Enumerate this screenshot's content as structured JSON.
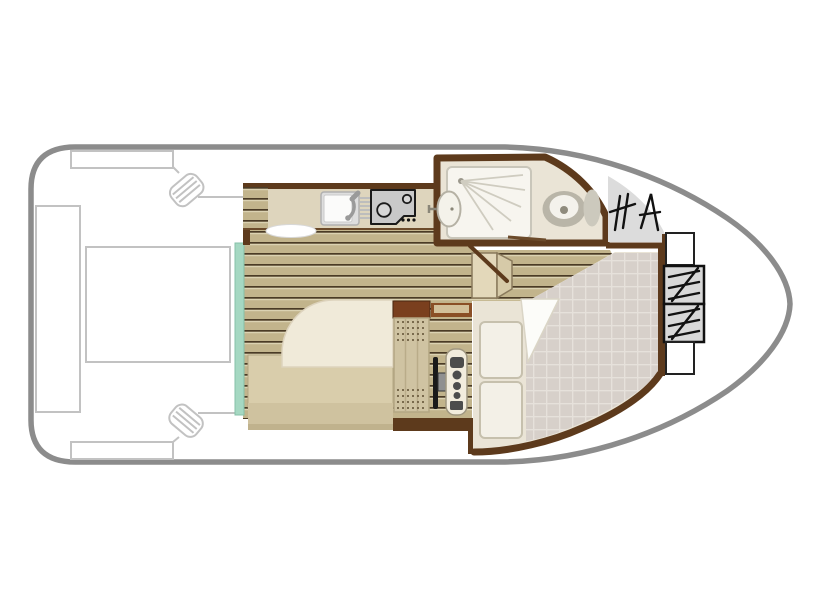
{
  "diagram": {
    "type": "boat-deck-floor-plan",
    "orientation": "bow-right-stern-left",
    "areas": [
      {
        "id": "aft-deck",
        "features": [
          "transom-bench",
          "deck-table",
          "side-walkway-port",
          "side-walkway-starboard",
          "cleat-port",
          "cleat-starboard"
        ]
      },
      {
        "id": "galley",
        "features": [
          "kitchen-counter",
          "side-cabinet",
          "sink",
          "faucet",
          "drainer",
          "stove-two-burner",
          "fold-table"
        ]
      },
      {
        "id": "saloon",
        "features": [
          "double-bed",
          "duvet",
          "entry-step-teal"
        ]
      },
      {
        "id": "helm",
        "features": [
          "helm-seat",
          "steering-wheel",
          "dashboard",
          "storage-cabinet",
          "shelf"
        ]
      },
      {
        "id": "bathroom",
        "features": [
          "shower",
          "washbasin",
          "toilet",
          "sliding-door"
        ]
      },
      {
        "id": "bow-cabin",
        "features": [
          "v-berth-quilted-mattress",
          "pillow-upper",
          "pillow-lower",
          "folded-sheet",
          "companionway-steps"
        ]
      },
      {
        "id": "bow-deck",
        "features": [
          "deck-steps-hatching",
          "step-box-upper",
          "step-box-lower",
          "locker-upper",
          "locker-lower"
        ]
      }
    ]
  },
  "colors": {
    "background": "#ffffff",
    "hull_outline": "#8c8c8c",
    "deck_outline": "#c2c2c2",
    "wall_brown": "#5d3a1c",
    "cabinet_brown": "#7a3f1e",
    "shelf_brown": "#8a4f26",
    "shelf_inlay": "#d2c09a",
    "plank_base": "#c2b48c",
    "plank_dark": "#4a3b26",
    "plank_light": "#dbd2b2",
    "counter": "#ded5bd",
    "counter_edge": "#6b4a2a",
    "teal_accent": "#a5d8c2",
    "teal_border": "#86c0a8",
    "bed_base": "#d9cdab",
    "bed_foot": "#cfc29f",
    "bed_blanket": "#f0ead9",
    "bed_blanket_edge": "#ddd3bd",
    "seat": "#cfc3a2",
    "seat_edge": "#b3a683",
    "stitch": "#6f5f42",
    "bathroom_floor": "#eae4d6",
    "fixture_white": "#f7f5ef",
    "fixture_edge": "#c9c6ba",
    "fixture_gray": "#b9b5a8",
    "tank_gray": "#ccc9bd",
    "deck_gray": "#dcdcdc",
    "stove_gray": "#c9c9c9",
    "quilt_base": "#d7d0ca",
    "quilt_line": "#e6e1db",
    "pillow": "#f3f0e7",
    "pillow_edge": "#c6c0ad",
    "steps_box": "#e3d8ba",
    "steps_box_side": "#d6caa8",
    "wheel_black": "#1a1a1a",
    "hub_gray": "#909090",
    "dash_panel": "#f2ecdd",
    "dash_button": "#4c4c4c"
  }
}
